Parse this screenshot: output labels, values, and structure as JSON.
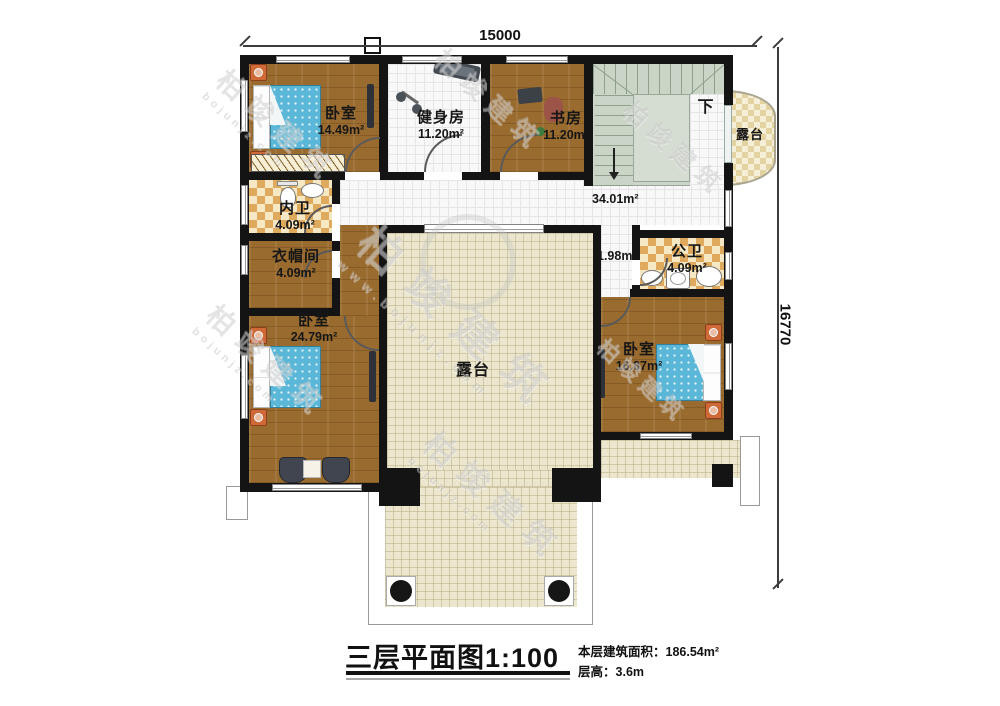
{
  "dimensions": {
    "top": "15000",
    "right": "16770"
  },
  "rooms": {
    "bedroom_top": {
      "name": "卧室",
      "area": "14.49m²"
    },
    "gym": {
      "name": "健身房",
      "area": "11.20m²"
    },
    "study": {
      "name": "书房",
      "area": "11.20m²"
    },
    "terrace_round": {
      "name": "露台"
    },
    "hallway": {
      "area": "34.01m²"
    },
    "inner_bath": {
      "name": "内卫",
      "area": "4.09m²"
    },
    "cloakroom": {
      "name": "衣帽间",
      "area": "4.09m²"
    },
    "bedroom_left": {
      "name": "卧室",
      "area": "24.79m²"
    },
    "corridor": {
      "area": "1.98m²"
    },
    "public_bath": {
      "name": "公卫",
      "area": "4.09m²"
    },
    "bedroom_right": {
      "name": "卧室",
      "area": "16.87m²"
    },
    "terrace_center": {
      "name": "露台"
    }
  },
  "stairs": {
    "down_label": "下"
  },
  "title_block": {
    "title": "三层平面图1:100",
    "floor_area_label": "本层建筑面积：",
    "floor_area_value": "186.54m²",
    "floor_height_label": "层高：",
    "floor_height_value": "3.6m"
  },
  "watermark": {
    "name": "柏竣建筑",
    "domain": "bojunjz.com",
    "domain_full": "www.bojunjz.com"
  },
  "colors": {
    "wall": "#141414",
    "wood_floor": "#9a6b2e",
    "terrace_tile": "#ece6ce",
    "bath_checker": "#dfa95e",
    "bed_blue": "#5bb7d8",
    "stairs": "#cbd5c7",
    "nightstand_orange": "#cf6a38"
  }
}
